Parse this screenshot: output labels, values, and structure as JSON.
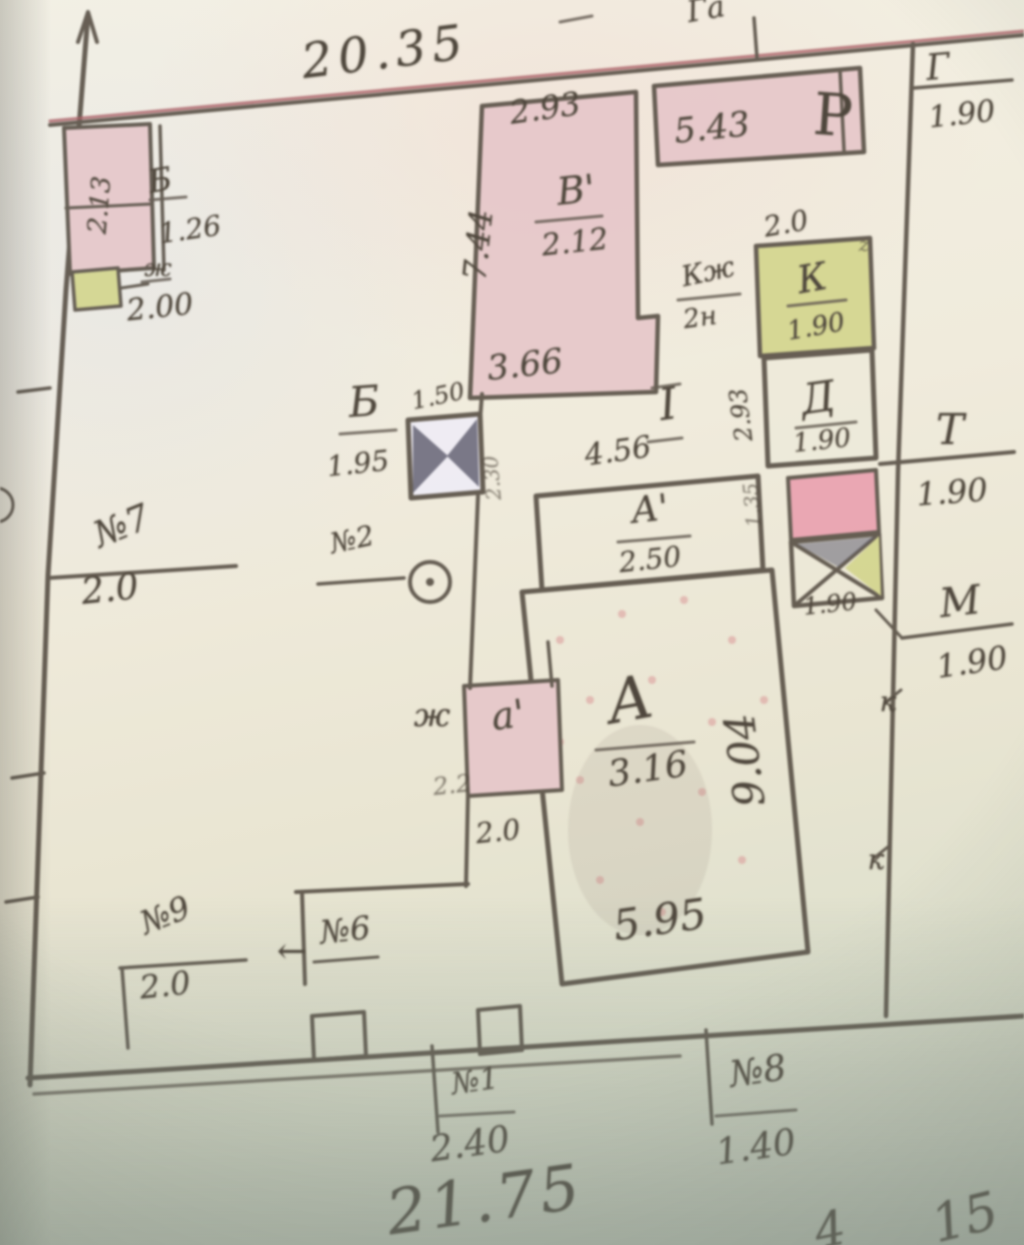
{
  "colors": {
    "ink": "#4e463c",
    "red_line": "#a34a52",
    "pink_fill": "#eac9cc",
    "pink_strong": "#ee9fb0",
    "yellow_fill": "#d5d88a",
    "gate_dark": "#4f4f64",
    "stipple": "#dd8e90",
    "paper_light": "#f2eedd"
  },
  "plot": {
    "top_width": "20.35",
    "bottom_width": "21.75",
    "corner_right_a": "4",
    "corner_right_b": "15"
  },
  "outbuildings": {
    "ul": {
      "label": "Б",
      "dim": "1.26",
      "inner_dim": "2.13",
      "zh": "ж",
      "zh_dim": "2.00"
    },
    "v1": {
      "label": "В'",
      "area": "2.12",
      "top": "2.93",
      "left": "7.44",
      "bottom": "3.66"
    },
    "r": {
      "label": "Р",
      "dim": "5.43",
      "ga": "Га",
      "g": "Г",
      "g_dim": "1.90"
    },
    "k": {
      "label": "К",
      "dim": "1.90",
      "top_dim": "2.0",
      "note1": "Кж",
      "note2": "2н"
    },
    "d": {
      "label": "Д",
      "dim": "1.90",
      "side_top": "2.93",
      "side_bottom": "1.35"
    },
    "t": {
      "label": "Т",
      "dim": "1.90",
      "gate_dim": "1.90"
    },
    "m": {
      "label": "М",
      "dim": "1.90"
    },
    "gate_b": {
      "label": "Б",
      "dim": "1.95",
      "width": "1.50",
      "side": "2.30"
    },
    "parcel": {
      "label": "I",
      "front": "4.56"
    },
    "a1": {
      "label": "А'",
      "area": "2.50"
    },
    "a": {
      "label": "А",
      "area": "3.16",
      "side": "9.04",
      "bottom": "5.95"
    },
    "a2": {
      "label": "а'",
      "zh": "ж",
      "mid_dim": "2.2",
      "bottom_dim": "2.0"
    }
  },
  "markers": {
    "n7": {
      "label": "№7",
      "dim": "2.0"
    },
    "n2": {
      "label": "№2"
    },
    "n9": {
      "label": "№9",
      "dim": "2.0"
    },
    "n6": {
      "label": "№6",
      "arrow": "←"
    },
    "n1": {
      "label": "№1",
      "dim": "2.40"
    },
    "n8": {
      "label": "№8",
      "dim": "1.40"
    },
    "k1": "к",
    "k2": "к",
    "z": "z"
  }
}
